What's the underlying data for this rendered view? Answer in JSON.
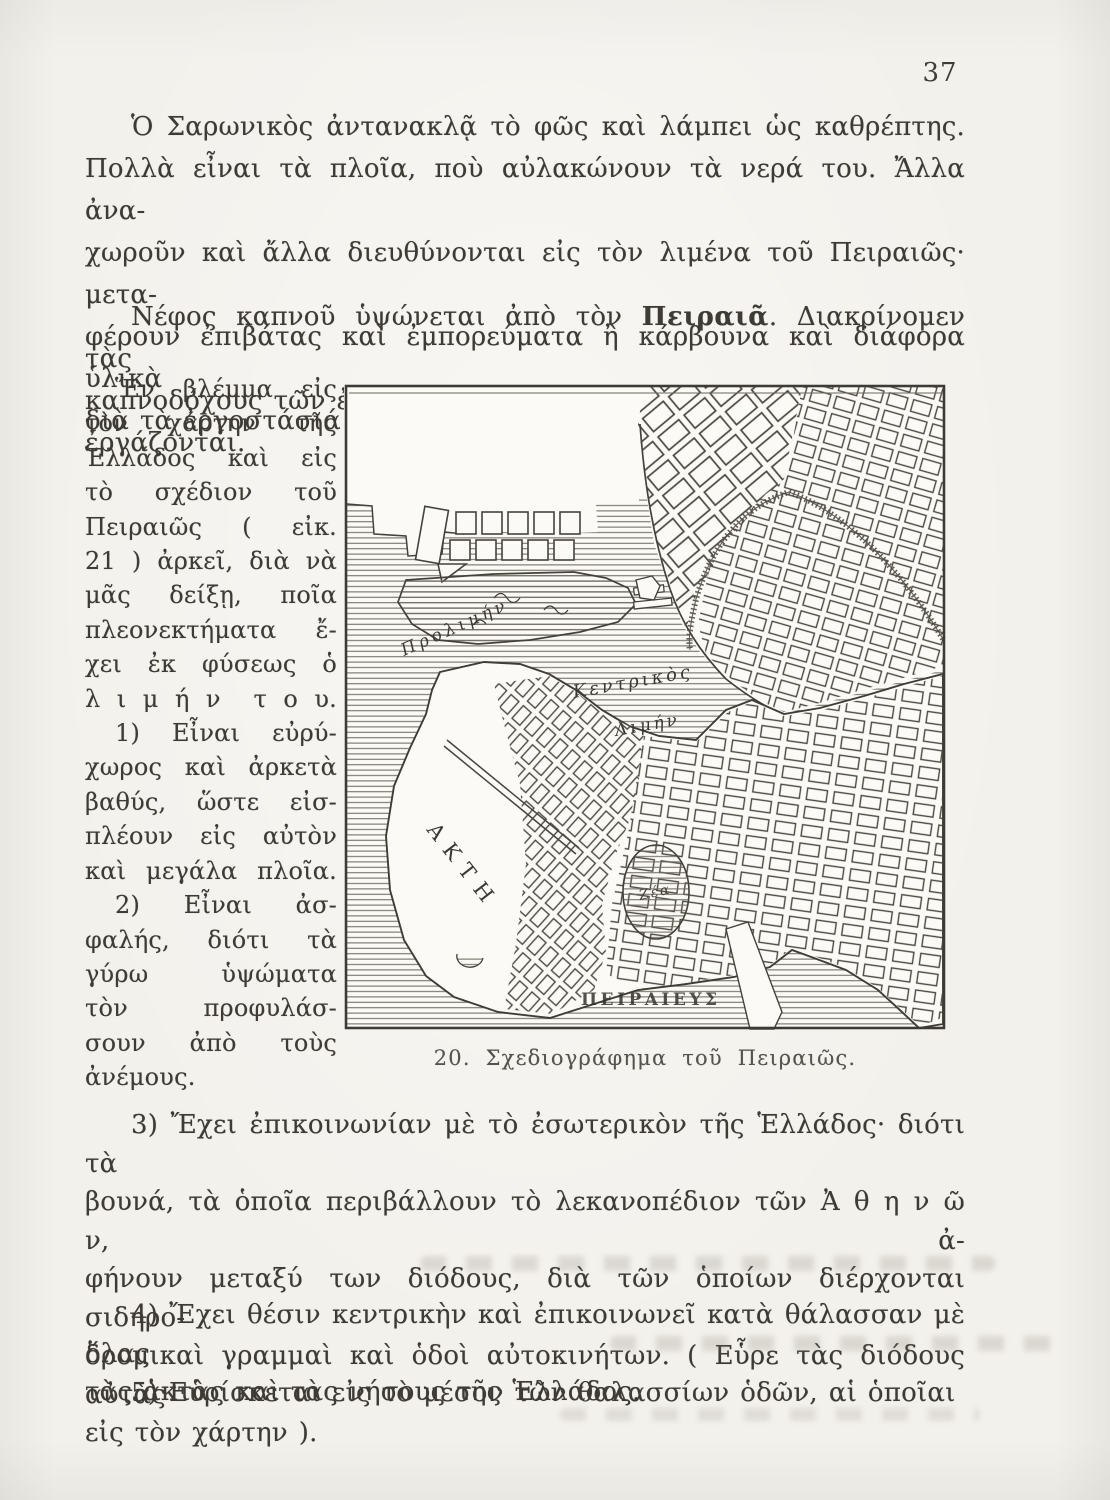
{
  "page": {
    "number": "37"
  },
  "para1": {
    "lines": [
      "Ὁ Σαρωνικὸς ἀντανακλᾷ τὸ φῶς καὶ λάμπει ὡς καθρέπτης.",
      "Πολλὰ εἶναι τὰ πλοῖα, ποὺ αὐλακώνουν τὰ νερά του. Ἄλλα ἀνα-",
      "χωροῦν καὶ ἄλλα διευθύνονται εἰς τὸν λιμένα τοῦ Πειραιῶς· μετα-",
      "φέρουν ἐπιβάτας καὶ ἐμπορεύματα ἢ κάρβουνα καὶ διάφορα ὑλικὰ",
      "διὰ τὰ ἐργοστάσιά του."
    ]
  },
  "para2": {
    "line1_pre": "Νέφος καπνοῦ ὑψώνεται ἀπὸ τὸν ",
    "line1_bold": "Πειραιᾶ",
    "line1_post": ". Διακρίνομεν τὰς",
    "line2": "καπνοδόχους τῶν ἐργοστασίων, ὅπου χιλιάδες ἐργατῶν ἐργάζονται."
  },
  "sidenote": {
    "lines": [
      "Ἕν βλέμμα εἰς",
      "τὸν χάρτην τῆς",
      "Ἑλλάδος καὶ εἰς",
      "τὸ σχέδιον τοῦ",
      "Πειραιῶς ( εἰκ.",
      "21 ) ἀρκεῖ, διὰ νὰ",
      "μᾶς δείξῃ, ποῖα",
      "πλεονεκτήματα ἔ-",
      "χει ἐκ φύσεως ὁ",
      "λ ι μ ή ν  τ ο υ.",
      "1) Εἶναι εὐρύ-",
      "χωρος καὶ ἀρκετὰ",
      "βαθύς, ὥστε εἰσ-",
      "πλέουν εἰς αὐτὸν",
      "καὶ μεγάλα πλοῖα.",
      "2) Εἶναι ἀσ-",
      "φαλής, διότι τὰ",
      "γύρω ὑψώματα",
      "τὸν προφυλάσ-",
      "σουν ἀπὸ τοὺς",
      "ἀνέμους."
    ]
  },
  "figure": {
    "caption": "20. Σχεδιογράφημα τοῦ Πειραιῶς.",
    "labels": {
      "outer_harbor": "Προλιμήν",
      "central_harbor_line1": "Κεντρικὸς",
      "central_harbor_line2": "Λιμήν",
      "peninsula": "ΑΚΤΗ",
      "zea_harbor": "Ζέα",
      "city_name": "ΠΕΙΡΑΙΕΥΣ"
    }
  },
  "para3": {
    "lines": [
      "3) Ἔχει ἐπικοινωνίαν μὲ τὸ ἐσωτερικὸν τῆς Ἑλλάδος· διότι τὰ",
      "βουνά, τὰ ὁποῖα περιβάλλουν τὸ λεκανοπέδιον τῶν Ἀ θ η ν ῶ ν, ἀ-",
      "φήνουν μεταξύ των διόδους, διὰ τῶν ὁποίων διέρχονται σιδηρο-",
      "δρομικαὶ γραμμαὶ καὶ ὁδοὶ αὐτοκινήτων. ( Εὗρε τὰς διόδους αὐτὰς",
      "εἰς τὸν χάρτην )."
    ]
  },
  "para4": {
    "lines": [
      "4) Ἔχει θέσιν κεντρικὴν καὶ ἐπικοινωνεῖ κατὰ θάλασσαν μὲ ὅλας",
      "τὰς ἀκτὰς καὶ τὰς νήσους τῆς Ἑλλάδος."
    ]
  },
  "para5": {
    "lines": [
      "5) Εὑρίσκεται εἰς τὸ μέσον τῶν θαλασσίων ὁδῶν, αἱ ὁποῖαι"
    ]
  },
  "colors": {
    "paper": "#f3f1ec",
    "ink": "#3e3b35",
    "map_ink": "#46423c"
  }
}
